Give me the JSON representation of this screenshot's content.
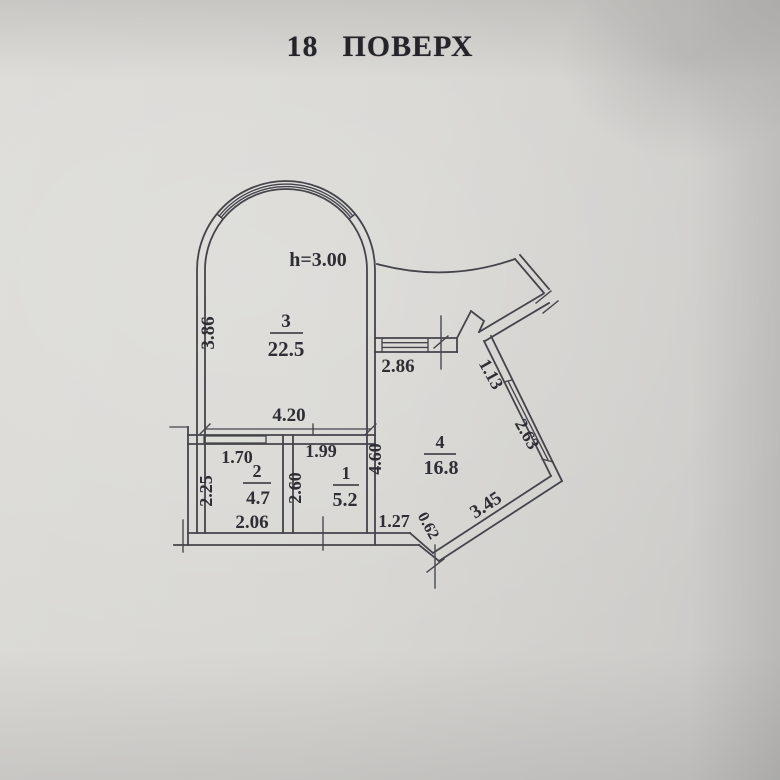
{
  "title": {
    "number": "18",
    "word": "ПОВЕРХ"
  },
  "plan": {
    "ceiling_height": "h=3.00",
    "rooms": [
      {
        "number": "3",
        "area": "22.5"
      },
      {
        "number": "2",
        "area": "4.7"
      },
      {
        "number": "1",
        "area": "5.2"
      },
      {
        "number": "4",
        "area": "16.8"
      }
    ],
    "dims": {
      "room3_left": "3.86",
      "room3_bottom": "4.20",
      "hall_width": "2.86",
      "diag_upper": "1.13",
      "diag_window": "2.63",
      "diag_lower": "3.45",
      "step": "0.62",
      "room4_side": "4.60",
      "room4_bottom": "1.27",
      "room2_top": "1.70",
      "room2_left": "2.25",
      "room2_bottom": "2.06",
      "room1_top": "1.99",
      "room1_left": "2.60"
    },
    "colors": {
      "paper": "#d6d5d1",
      "line": "#45444b",
      "text": "#2f2e34"
    }
  }
}
